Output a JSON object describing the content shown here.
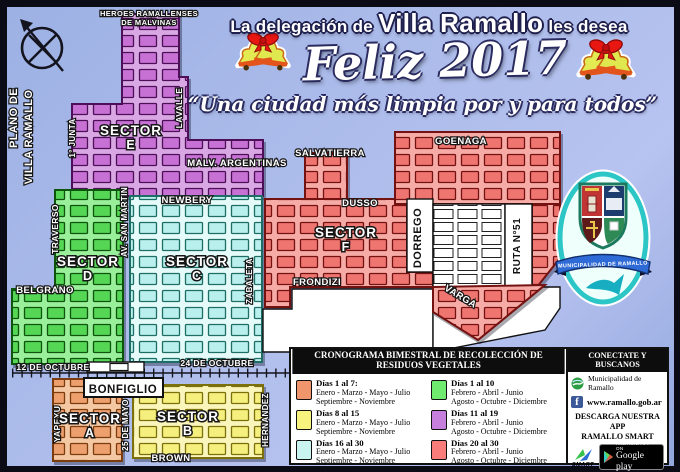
{
  "header": {
    "line1_prefix": "La delegación de",
    "line1_highlight": "Villa Ramallo",
    "line1_suffix": "les desea",
    "greeting": "Feliz 2017",
    "quote": "“Una ciudad más limpia por y para todos”"
  },
  "map": {
    "title_line1": "PLANO DE",
    "title_line2": "VILLA RAMALLO",
    "sectors": [
      {
        "name": "SECTOR",
        "letter": "E",
        "color": "#c671d3"
      },
      {
        "name": "SECTOR",
        "letter": "D",
        "color": "#55d655"
      },
      {
        "name": "SECTOR",
        "letter": "C",
        "color": "#b9efec"
      },
      {
        "name": "SECTOR",
        "letter": "F",
        "color": "#ef7570"
      },
      {
        "name": "SECTOR",
        "letter": "A",
        "color": "#eda06e"
      },
      {
        "name": "SECTOR",
        "letter": "B",
        "color": "#f5ef7e"
      }
    ],
    "streets": {
      "heroes1": "HEROES RAMALLENSES",
      "heroes2": "DE MALVINAS",
      "junta": "1° JUNTA",
      "lavalle": "LAVALLE",
      "malvinas": "MALV. ARGENTINAS",
      "salvatierra": "SALVATIERRA",
      "goenaga": "GOENAGA",
      "newbery": "NEWBERY",
      "dusso": "DUSSO",
      "dorrego": "DORREGO",
      "ruta": "RUTA N°51",
      "sanmartin": "AV. SAN MARTIN",
      "traverso": "TRAVERSO",
      "belgrano": "BELGRANO",
      "zabaleta": "ZABALETA",
      "frondizi": "FRONDIZI",
      "varga": "VARGA",
      "octubre12": "12 DE OCTUBRE",
      "octubre24": "24 DE OCTUBRE",
      "bonfiglio": "BONFIGLIO",
      "yapeyu": "YAPEYU",
      "mayo25": "25 DE MAYO",
      "hernandez": "HERNANDEZ",
      "brown": "BROWN"
    }
  },
  "badge": {
    "ribbon": "MUNICIPALIDAD DE RAMALLO"
  },
  "schedule": {
    "title": "CRONOGRAMA BIMESTRAL DE RECOLECCIÓN DE RESIDUOS VEGETALES",
    "entries": [
      {
        "days": "Días 1 al 7:",
        "months1": "Enero - Marzo - Mayo - Julio",
        "months2": "Septiembre - Noviembre",
        "color": "#f0956c"
      },
      {
        "days": "Días 8 al 15",
        "months1": "Enero - Marzo - Mayo - Julio",
        "months2": "Septiembre - Noviembre",
        "color": "#f8f37e"
      },
      {
        "days": "Días 16 al 30",
        "months1": "Enero - Marzo - Mayo - Julio",
        "months2": "Septiembre - Noviembre",
        "color": "#c9f4f0"
      },
      {
        "days": "Días 1 al 10",
        "months1": "Febrero - Abril - Junio",
        "months2": "Agosto - Octubre - Diciembre",
        "color": "#6fec6f"
      },
      {
        "days": "Días 11 al 19",
        "months1": "Febrero - Abril - Junio",
        "months2": "Agosto - Octubre - Diciembre",
        "color": "#c77fdd"
      },
      {
        "days": "Días 20 al 30",
        "months1": "Febrero - Abril - Junio",
        "months2": "Agosto - Octubre - Diciembre",
        "color": "#f87d7a"
      }
    ]
  },
  "connect": {
    "title": "CONECTATE Y BUSCANOS",
    "municipality": "Municipalidad de Ramallo",
    "website": "www.ramallo.gob.ar",
    "app_line1": "DESCARGA  NUESTRA APP",
    "app_line2": "RAMALLO SMART",
    "smart_label": "SMART",
    "facebook_letter": "f",
    "play_line1": "ANDROID APP ON",
    "play_line2": "Google play"
  }
}
